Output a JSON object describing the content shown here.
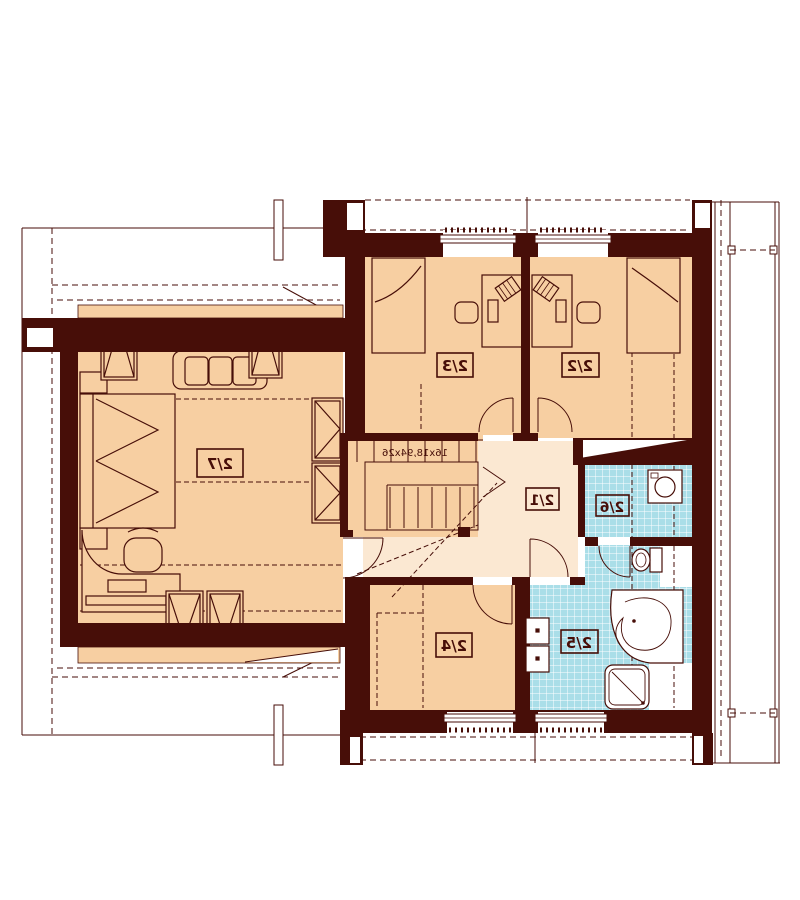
{
  "plan": {
    "stair_text": "16x18,94x26",
    "room_labels": {
      "r27": "2/7",
      "r23": "2/3",
      "r22": "2/2",
      "r21": "2/1",
      "r26": "2/6",
      "r25": "2/5",
      "r24": "2/4"
    },
    "colors": {
      "wall": "#470e08",
      "line": "#470e08",
      "room_floor": "#f7cfa2",
      "hall_floor": "#fbe8d2",
      "bath_tile": "#aadee8",
      "tile_grid": "#ffffff",
      "background": "#ffffff"
    }
  }
}
